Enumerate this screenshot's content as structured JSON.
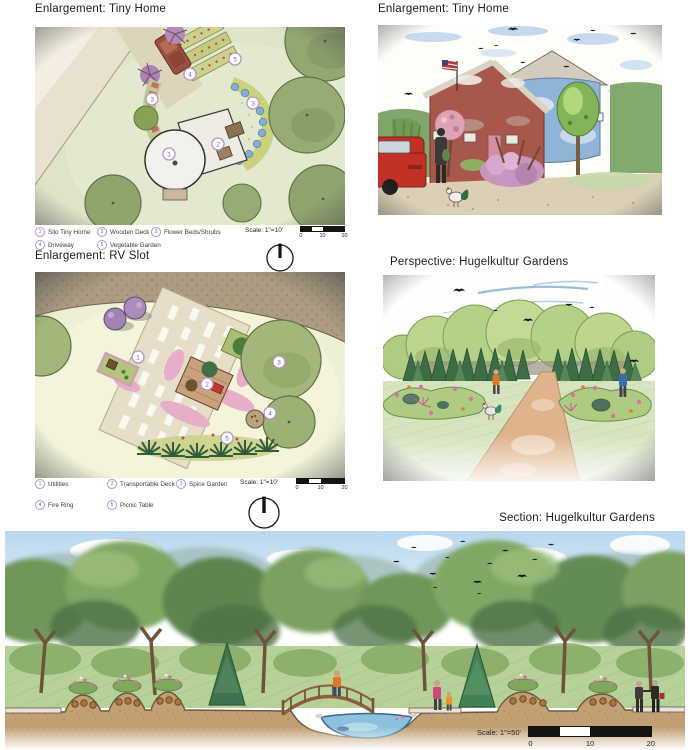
{
  "document": {
    "background": "#ffffff"
  },
  "colors": {
    "title_text": "#1b1b1b",
    "legend_marker_ring": "#b295c6",
    "legend_number": "#7b5fa0",
    "scale_bar": "#141414"
  },
  "panels": {
    "tiny_home_plan": {
      "title": "Enlargement: Tiny Home",
      "legend": [
        {
          "num": "1",
          "label": "Silo Tiny Home"
        },
        {
          "num": "2",
          "label": "Wooden Deck"
        },
        {
          "num": "3",
          "label": "Flower Beds/Shrubs"
        },
        {
          "num": "4",
          "label": "Driveway"
        },
        {
          "num": "5",
          "label": "Vegetable Garden"
        }
      ],
      "marker_numbers": [
        "1",
        "2",
        "3",
        "3",
        "4",
        "5"
      ],
      "scale_label": "Scale: 1\"=10'",
      "scale_ticks": [
        "0",
        "10",
        "20"
      ]
    },
    "tiny_home_perspective": {
      "title": "Enlargement: Tiny Home"
    },
    "rv_slot_plan": {
      "title": "Enlargement: RV Slot",
      "legend": [
        {
          "num": "1",
          "label": "Utilities"
        },
        {
          "num": "2",
          "label": "Transportable Deck"
        },
        {
          "num": "3",
          "label": "Spice Garden"
        },
        {
          "num": "4",
          "label": "Fire Ring"
        },
        {
          "num": "5",
          "label": "Picnic Table"
        }
      ],
      "marker_numbers": [
        "1",
        "2",
        "3",
        "4",
        "5"
      ],
      "scale_label": "Scale: 1\"=10'",
      "scale_ticks": [
        "0",
        "10",
        "20"
      ]
    },
    "hugelkultur_perspective": {
      "title": "Perspective: Hugelkultur Gardens"
    },
    "hugelkultur_section": {
      "title": "Section: Hugelkultur Gardens",
      "scale_label": "Scale: 1\"=50'",
      "scale_ticks": [
        "0",
        "10",
        "20"
      ]
    }
  }
}
